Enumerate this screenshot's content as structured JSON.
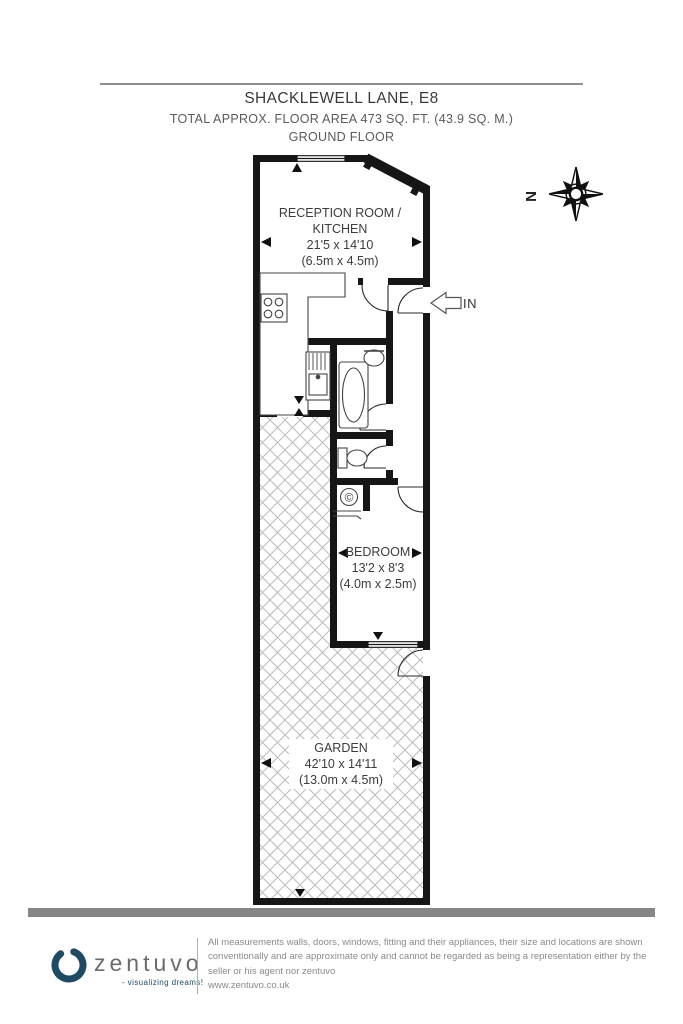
{
  "header": {
    "title": "SHACKLEWELL LANE, E8",
    "area_line": "TOTAL APPROX. FLOOR AREA 473 SQ. FT. (43.9 SQ. M.)",
    "floor_line": "GROUND FLOOR"
  },
  "compass": {
    "north_label": "N"
  },
  "plan": {
    "entrance_label": "IN",
    "boiler_symbol": "©",
    "rooms": {
      "reception": {
        "name_line1": "RECEPTION ROOM /",
        "name_line2": "KITCHEN",
        "size_imperial": "21'5 x 14'10",
        "size_metric": "(6.5m x 4.5m)"
      },
      "bedroom": {
        "name": "BEDROOM",
        "size_imperial": "13'2 x 8'3",
        "size_metric": "(4.0m x 2.5m)"
      },
      "garden": {
        "name": "GARDEN",
        "size_imperial": "42'10 x 14'11",
        "size_metric": "(13.0m x 4.5m)"
      }
    }
  },
  "footer": {
    "logo_text": "zentuvo",
    "logo_tagline": "- visualizing dreams!",
    "disclaimer": "All measurements walls, doors, windows, fitting and their appliances, their size and locations are shown conventionally and are approximate only and cannot be regarded as being a representation either by the seller or his agent nor zentuvo",
    "website": "www.zentuvo.co.uk"
  },
  "colors": {
    "wall": "#161616",
    "hatch": "#bbbbbb",
    "accent_navy": "#1e4b63",
    "footer_bar": "#868686"
  }
}
